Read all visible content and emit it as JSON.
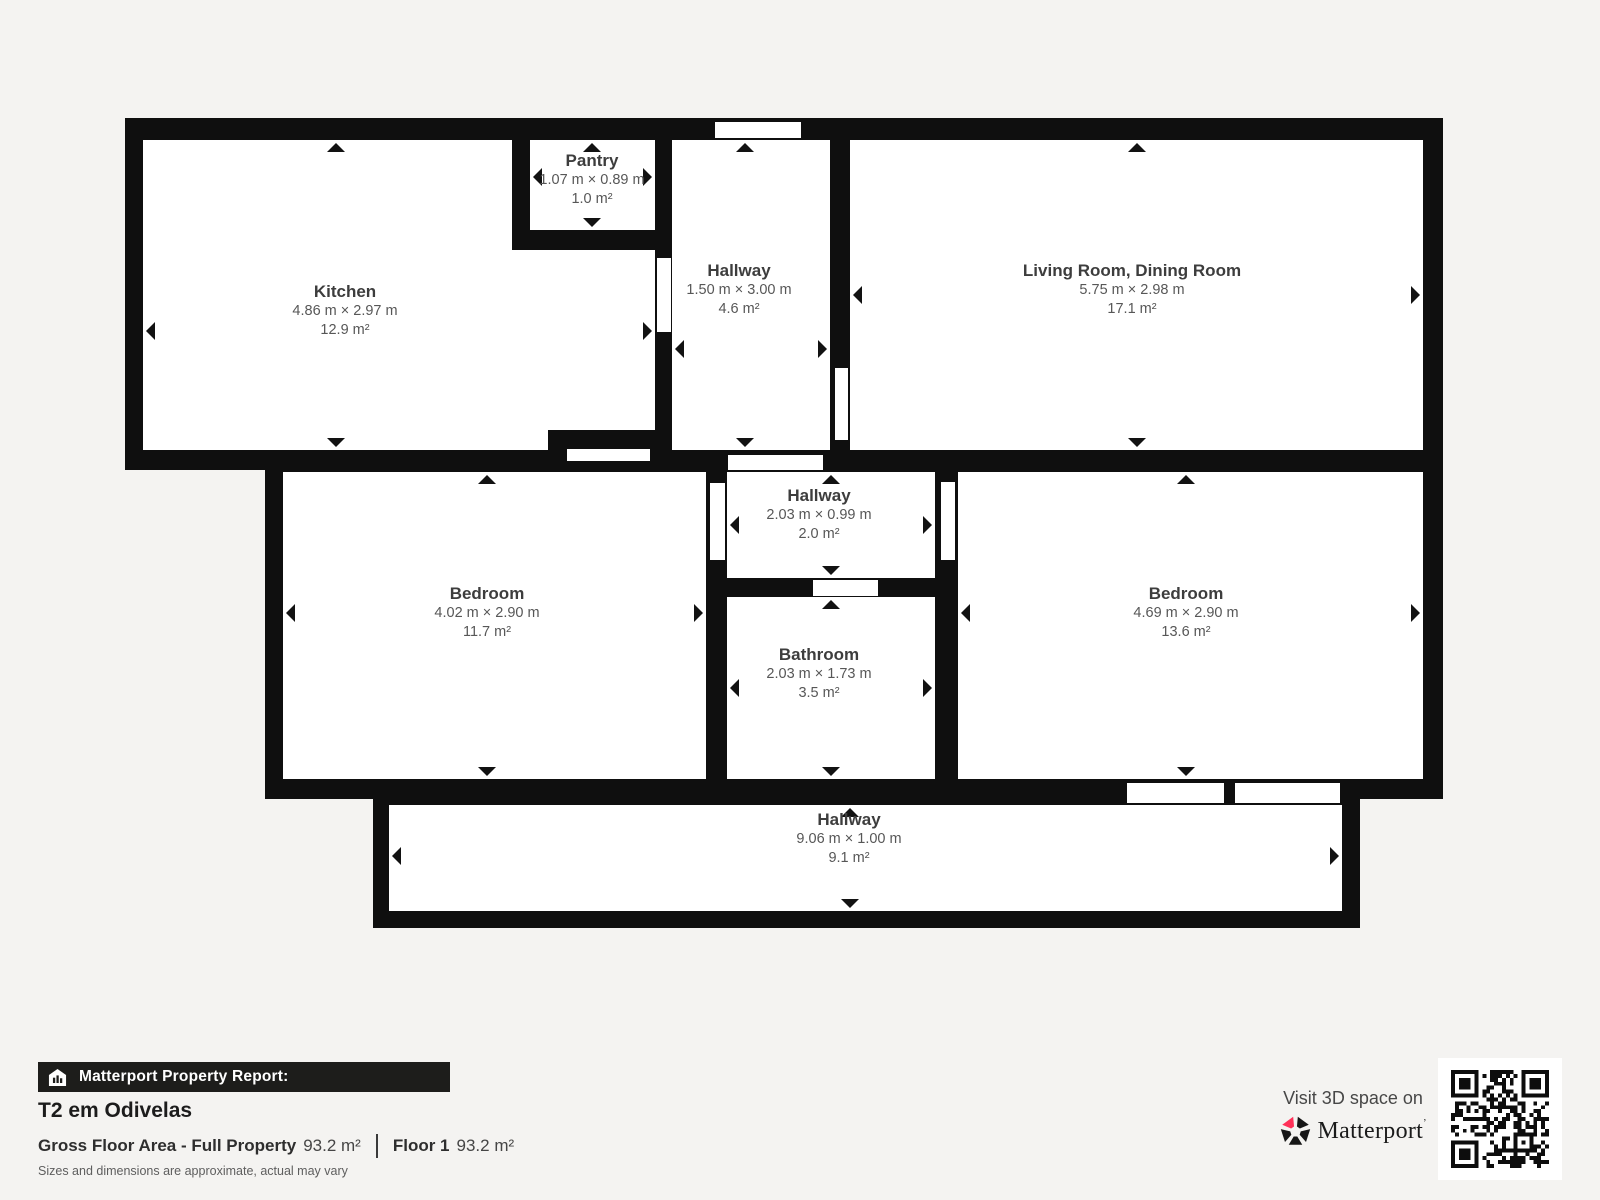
{
  "plan": {
    "rooms": [
      {
        "id": "kitchen",
        "name": "Kitchen",
        "dims": "4.86 m × 2.97 m",
        "area": "12.9 m²"
      },
      {
        "id": "pantry",
        "name": "Pantry",
        "dims": "1.07 m × 0.89 m",
        "area": "1.0 m²"
      },
      {
        "id": "hallway-top",
        "name": "Hallway",
        "dims": "1.50 m × 3.00 m",
        "area": "4.6 m²"
      },
      {
        "id": "living-room",
        "name": "Living Room, Dining Room",
        "dims": "5.75 m × 2.98 m",
        "area": "17.1 m²"
      },
      {
        "id": "bedroom-left",
        "name": "Bedroom",
        "dims": "4.02 m × 2.90 m",
        "area": "11.7 m²"
      },
      {
        "id": "hallway-middle",
        "name": "Hallway",
        "dims": "2.03 m × 0.99 m",
        "area": "2.0 m²"
      },
      {
        "id": "bathroom",
        "name": "Bathroom",
        "dims": "2.03 m × 1.73 m",
        "area": "3.5 m²"
      },
      {
        "id": "bedroom-right",
        "name": "Bedroom",
        "dims": "4.69 m × 2.90 m",
        "area": "13.6 m²"
      },
      {
        "id": "hallway-bottom",
        "name": "Hallway",
        "dims": "9.06 m × 1.00 m",
        "area": "9.1 m²"
      }
    ]
  },
  "report": {
    "bar_label": "Matterport Property Report:",
    "title": "T2 em Odivelas",
    "gfa_label": "Gross Floor Area - Full Property",
    "gfa_value": "93.2 m²",
    "floor_label": "Floor 1",
    "floor_value": "93.2 m²",
    "disclaimer": "Sizes and dimensions are approximate, actual may vary"
  },
  "promo": {
    "visit_label": "Visit 3D space on",
    "brand": "Matterport",
    "brand_mark": "’"
  },
  "colors": {
    "wall": "#0f0f0f",
    "room_fill": "#ffffff",
    "background": "#f4f3f1",
    "brand_pink": "#ff3158",
    "bar_background": "#1d1d1b"
  }
}
